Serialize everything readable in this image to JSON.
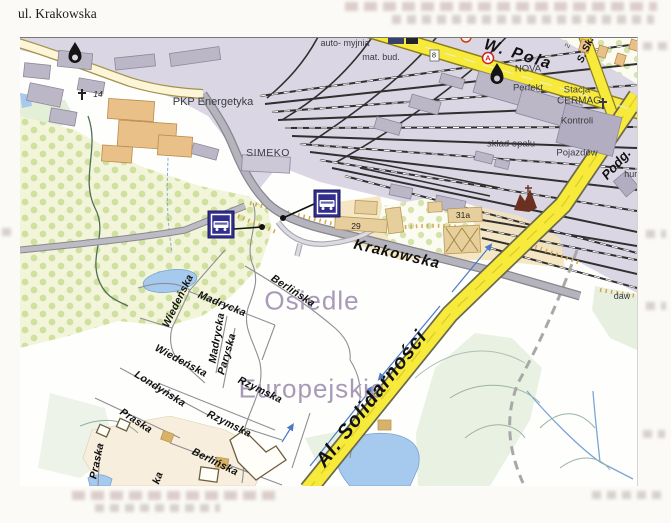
{
  "page": {
    "title": "ul. Krakowska"
  },
  "map": {
    "labels": {
      "pkp_energetyka": "PKP Energetyka",
      "simeko": "SIMEKO",
      "auto_myjnia": "auto- myjnia",
      "mat_bud": "mat. bud.",
      "w_pola": "W. Pola",
      "nova": "NOVA",
      "perfekt": "Perfekt",
      "cermag": "CERMAG",
      "stacja_l1": "Stacja",
      "stacja_l2": "Kontroli",
      "stacja_l3": "Pojazdów",
      "sklad_opalu": "skład opału",
      "s_sk": "S. Sk.",
      "podg": "Podg.",
      "hurt": "hurt",
      "num_29": "29",
      "num_31a": "31a",
      "krakowska": "Krakowska",
      "osiedle_l1": "Osiedle",
      "osiedle_l2": "Europejskie",
      "al_solidarnosci": "Al. Solidarności",
      "wiedenska": "Wiedeńska",
      "madrycka": "Madrycka",
      "berlinska": "Berlińska",
      "paryska": "Paryska",
      "londynska": "Londyńska",
      "rzymska": "Rzymska",
      "praska": "Praska",
      "ka_fragment": "ka",
      "daw": "daw",
      "num_14": "14",
      "num_8": "8",
      "num_2": "2",
      "marker_a": "A"
    },
    "bus_stop_count": 2,
    "colors": {
      "road_major_yellow": "#f7ea3b",
      "railway_area": "#dad6e4",
      "water": "#a6c9ee",
      "orchard": "#f2f5da",
      "district_label": "#a79ab8",
      "bus_marker_navy": "#312e8e",
      "marker_red": "#cc2020"
    }
  }
}
